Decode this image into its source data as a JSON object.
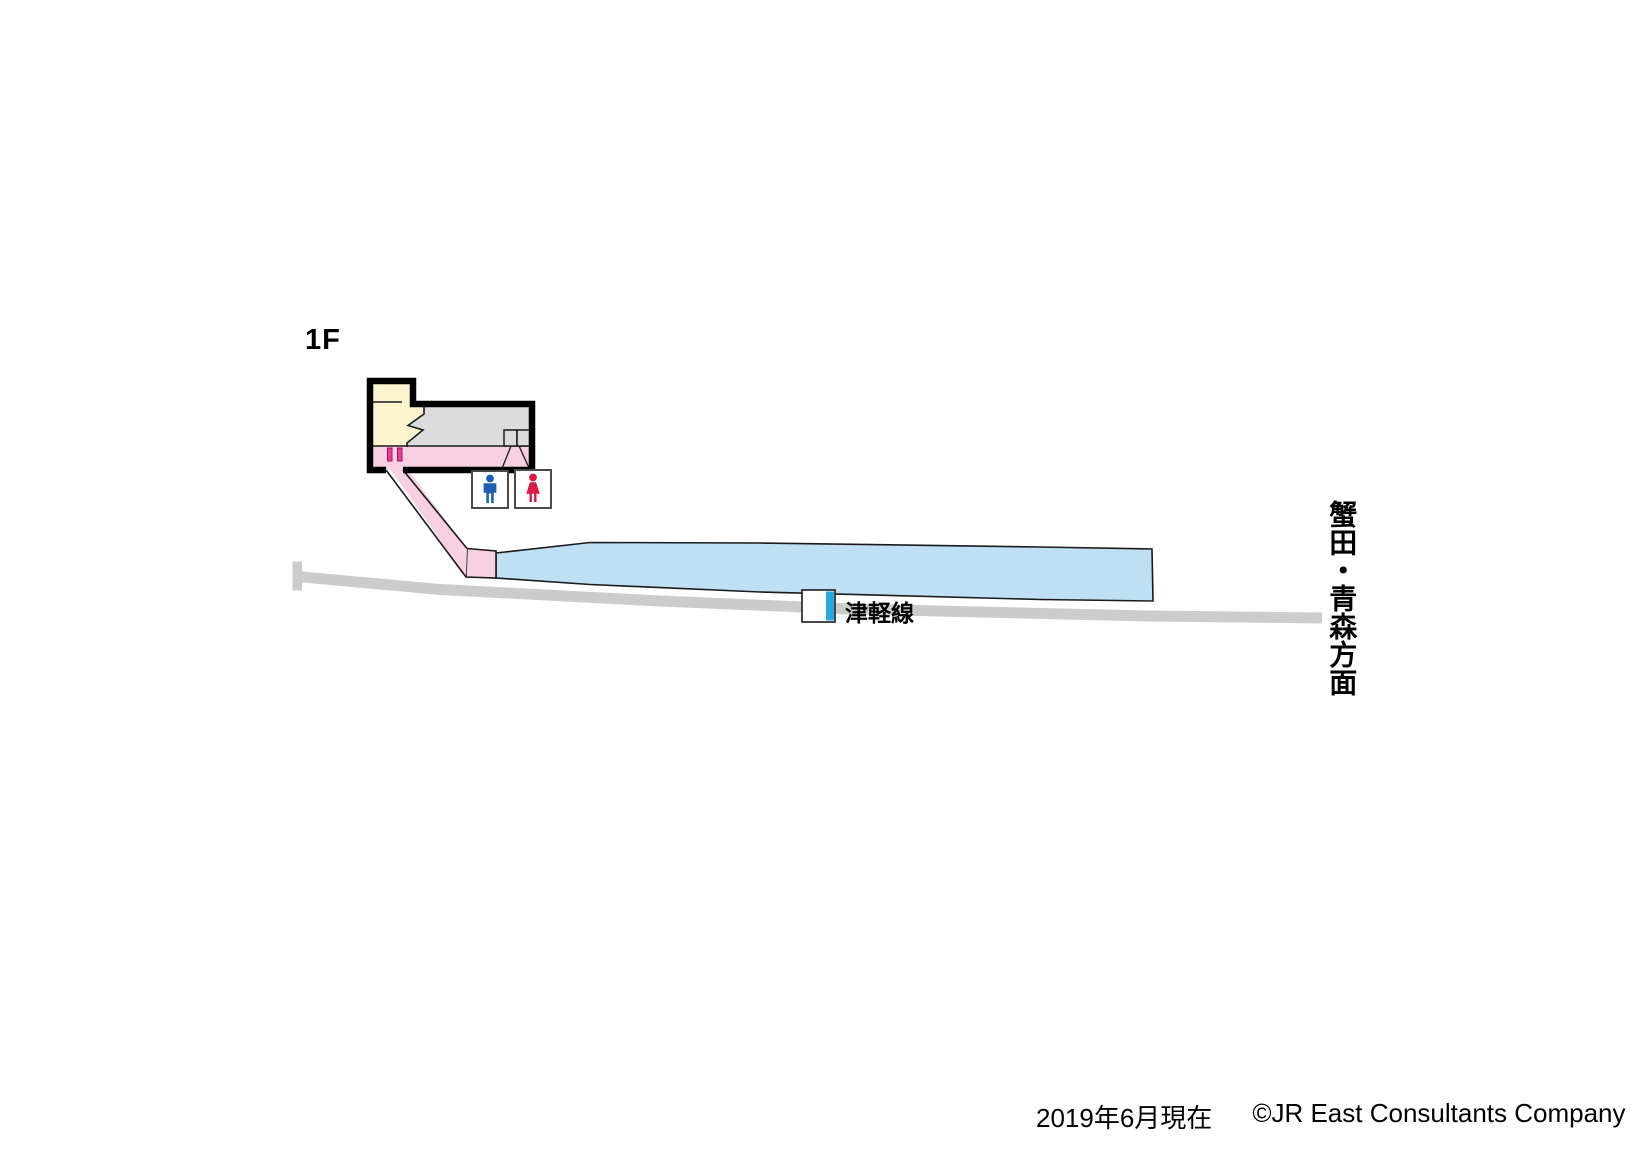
{
  "floor_label": "1F",
  "map": {
    "line_label": "津軽線",
    "direction_label": "蟹田・青森方面"
  },
  "footer": {
    "date_note": "2019年6月現在",
    "copyright": "©JR East Consultants Company"
  },
  "icons": {
    "male_restroom": "male-figure-pictogram",
    "female_restroom": "female-figure-pictogram",
    "train_position": "train-car-marker",
    "track_end": "buffer-stop"
  },
  "colors": {
    "platform_blue": "#BEDFF4",
    "walkway_pink": "#F7D0E2",
    "ticket_gate_magenta": "#E8408F",
    "waiting_room_yellow": "#FCF4CF",
    "office_gray": "#DCDCDC",
    "track_gray": "#CCCCCC",
    "train_marker_blue": "#29A9E0",
    "male_icon_blue": "#1D5FB2",
    "female_icon_red": "#DC1844",
    "wall_black": "#000000"
  }
}
